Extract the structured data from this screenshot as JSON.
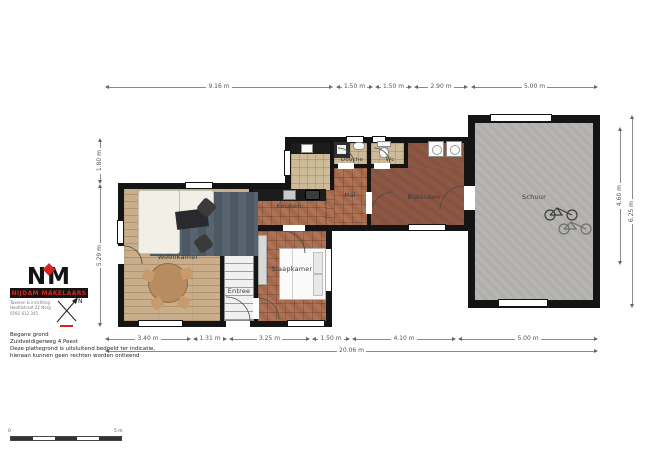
{
  "rooms": {
    "woonkamer": "Woonkamer",
    "keuken": "Keuken",
    "slaapkamer": "Slaapkamer",
    "entree": "Entree",
    "hal": "Hal",
    "douche": "Douche",
    "wc": "Wc",
    "bijkeuken": "Bijkeuken",
    "schuur": "Schuur"
  },
  "dimensions": {
    "top": [
      "9.16 m",
      "1.50 m",
      "1.50 m",
      "2.90 m",
      "5.00 m"
    ],
    "bottom": [
      "3.40 m",
      "1.31 m",
      "3.25 m",
      "1.50 m",
      "4.10 m",
      "5.00 m"
    ],
    "bottom_total": "20.06 m",
    "left": [
      "1.80 m",
      "5.29 m"
    ],
    "right": [
      "4.60 m",
      "6.25 m"
    ]
  },
  "footer": {
    "floor": "Begane grond",
    "address": "Zuidveldigerweg 4 Peest",
    "disclaimer1": "Deze plattegrond is uitsluitend bedoeld ter indicatie,",
    "disclaimer2": "hieraan kunnen geen rechten worden ontleend"
  },
  "logo": {
    "letter_n": "N",
    "letter_m": "M",
    "name": "NIJDAM MAKELAARS",
    "sub1": "Taxeren & inrichting",
    "sub2": "Hoofdstraat 22 Norg",
    "sub3": "0592 612 345"
  },
  "compass": {
    "north": "N"
  },
  "scalebar": {
    "zero": "0",
    "five": "5 m"
  },
  "colors": {
    "wall": "#141414",
    "terracotta_tile": "#a7684a",
    "wood_floor": "#c9ae8c",
    "bijkeuken_floor": "#8d5743",
    "schuur_floor": "#b7b5b2",
    "logo_red": "#d8241f"
  }
}
